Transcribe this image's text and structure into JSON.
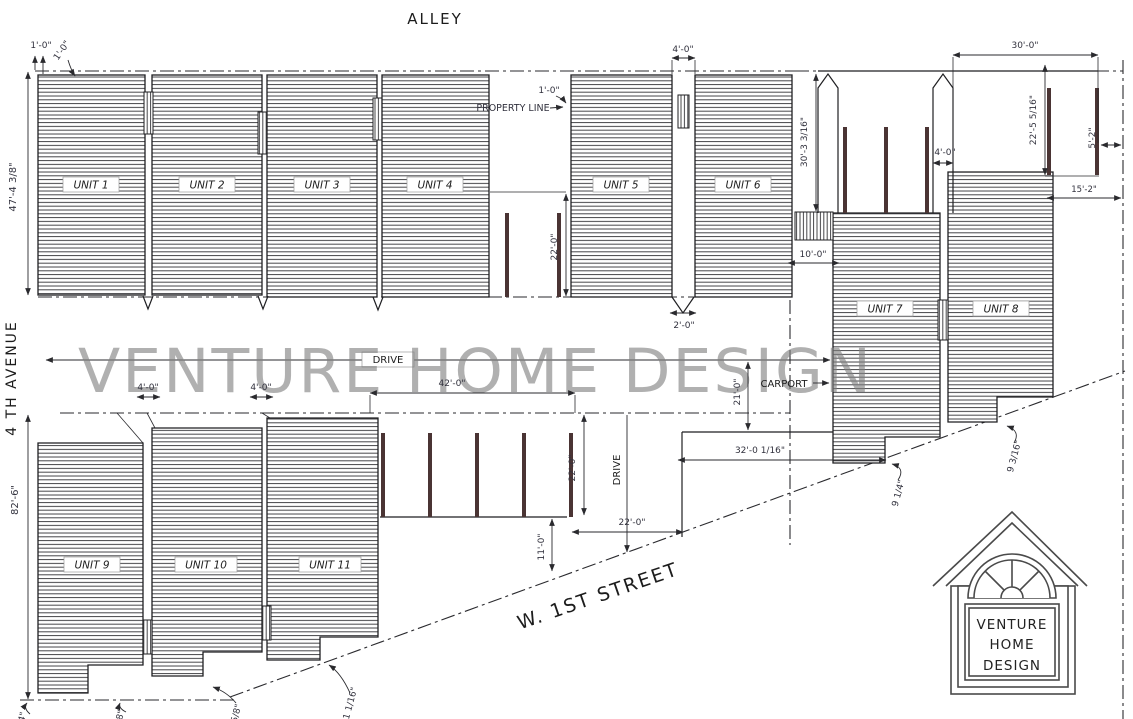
{
  "drawing": {
    "watermark": "VENTURE HOME DESIGN",
    "streets": {
      "alley": "ALLEY",
      "avenue": "4 TH AVENUE",
      "first_street": "W. 1ST STREET"
    },
    "areas": {
      "drive_main": "DRIVE",
      "drive_south": "DRIVE",
      "carport": "CARPORT",
      "property_line": "PROPERTY LINE"
    },
    "units": {
      "u1": "UNIT 1",
      "u2": "UNIT 2",
      "u3": "UNIT 3",
      "u4": "UNIT 4",
      "u5": "UNIT 5",
      "u6": "UNIT 6",
      "u7": "UNIT 7",
      "u8": "UNIT 8",
      "u9": "UNIT 9",
      "u10": "UNIT 10",
      "u11": "UNIT 11"
    },
    "dimensions": {
      "alley_offset_a": "1'-0\"",
      "alley_offset_b": "1'-0\"",
      "row_depth": "47'-4 3/8\"",
      "property_offset": "1'-0\"",
      "breezeway_56": "4'-0\"",
      "court_depth": "22'-0\"",
      "notch_56": "2'-0\"",
      "carport_span": "30'-0\"",
      "east_depth_a": "30'-3 3/16\"",
      "east_depth_b": "22'-5 5/16\"",
      "east_gap": "5'-2\"",
      "east_setback": "15'-2\"",
      "post_bay": "4'-0\"",
      "stair_width": "10'-0\"",
      "parking_width": "42'-0\"",
      "parking_depth": "22'-0\"",
      "carport_depth": "21'-0\"",
      "slab_width": "32'-0 1/16\"",
      "seam_a": "9 1/4\"",
      "seam_b": "9 3/16\"",
      "west_depth": "82'-6\"",
      "entry_10": "4'-0\"",
      "entry_11": "4'-0\"",
      "apron": "22'-0\"",
      "street_setback": "11'-0\"",
      "edge_a": "1/4\"",
      "edge_b": "5/8\"",
      "edge_c": "5/8\"",
      "edge_d": "1 1/16\""
    },
    "logo": {
      "line1": "VENTURE",
      "line2": "HOME",
      "line3": "DESIGN"
    },
    "colors": {
      "paper": "#ffffff",
      "ink": "#2a2a2e",
      "dim_text": "#32323e",
      "watermark_gray": "#7f7f7f",
      "stall_post": "#4a3434"
    }
  }
}
